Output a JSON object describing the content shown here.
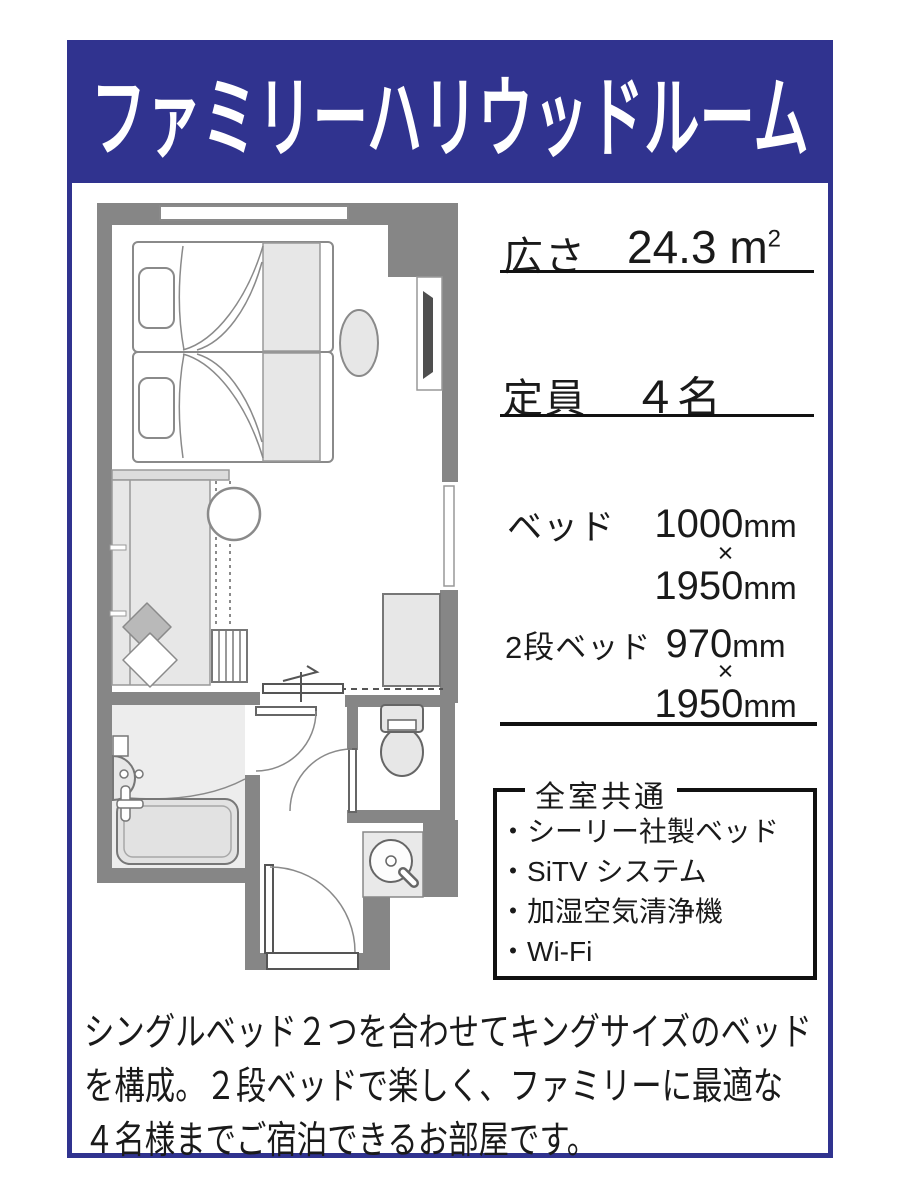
{
  "header": {
    "title": "ファミリーハリウッドルーム"
  },
  "specs": {
    "area": {
      "label": "広さ",
      "value": "24.3",
      "unit": "m",
      "unit_exp": "2"
    },
    "capacity": {
      "label": "定員",
      "value": "４名"
    },
    "bed": {
      "label": "ベッド",
      "width": "1000",
      "width_unit": "mm",
      "times": "×",
      "length": "1950",
      "length_unit": "mm"
    },
    "bunk": {
      "label": "2段ベッド",
      "width": "970",
      "width_unit": "mm",
      "times": "×",
      "length": "1950",
      "length_unit": "mm"
    }
  },
  "amenities": {
    "title": "全室共通",
    "items": [
      "シーリー社製ベッド",
      "SiTV システム",
      "加湿空気清浄機",
      "Wi-Fi"
    ]
  },
  "description": {
    "lines": [
      "シングルベッド２つを合わせてキングサイズのベッド",
      "を構成。２段ベッドで楽しく、ファミリーに最適な",
      "４名様までご宿泊できるお部屋です。"
    ]
  },
  "floor_plan": {
    "name": "guest-room-floor-plan",
    "elements": [
      "window",
      "twin-beds",
      "pillows",
      "duvet",
      "ottoman",
      "tv-cabinet",
      "counter",
      "bunk-bed",
      "ladder",
      "cushions",
      "round-stool",
      "sliding-partition",
      "closet",
      "bathroom",
      "bathtub",
      "washbasin",
      "mixer-tap",
      "bathroom-door",
      "toilet",
      "toilet-door",
      "vanity-sink",
      "entrance-door",
      "threshold"
    ]
  },
  "colors": {
    "navy": "#30338f",
    "wall": "#868686",
    "light_fill": "#e7e7e7",
    "text": "#1a1a1a"
  }
}
